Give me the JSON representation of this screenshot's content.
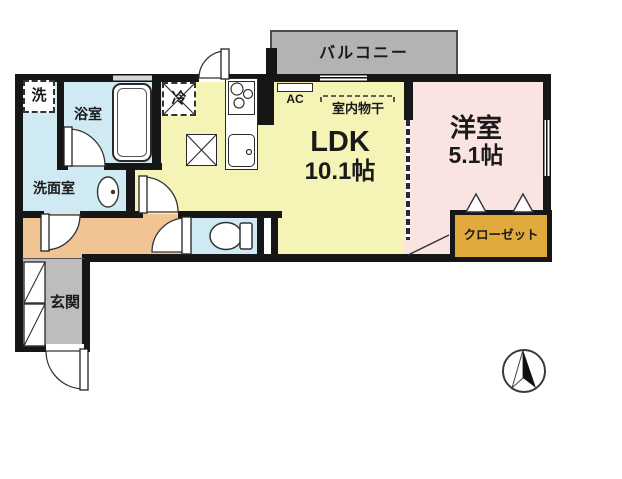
{
  "rooms": {
    "balcony": "バルコニー",
    "ldk_name": "LDK",
    "ldk_area": "10.1帖",
    "western_name": "洋室",
    "western_area": "5.1帖",
    "closet": "クローゼット",
    "bathroom": "浴室",
    "washroom": "洗面室",
    "entrance": "玄関"
  },
  "fixtures": {
    "washer": "洗",
    "fridge": "冷",
    "ac": "AC",
    "indoor_drying": "室内物干"
  },
  "colors": {
    "ldk": "#f6f3b6",
    "western_room": "#fae4e2",
    "wet_area": "#cfeaf2",
    "hallway": "#f0c493",
    "entrance": "#bdbdbd",
    "closet": "#e2a93c",
    "balcony": "#b3b3b3",
    "wall": "#161616"
  }
}
